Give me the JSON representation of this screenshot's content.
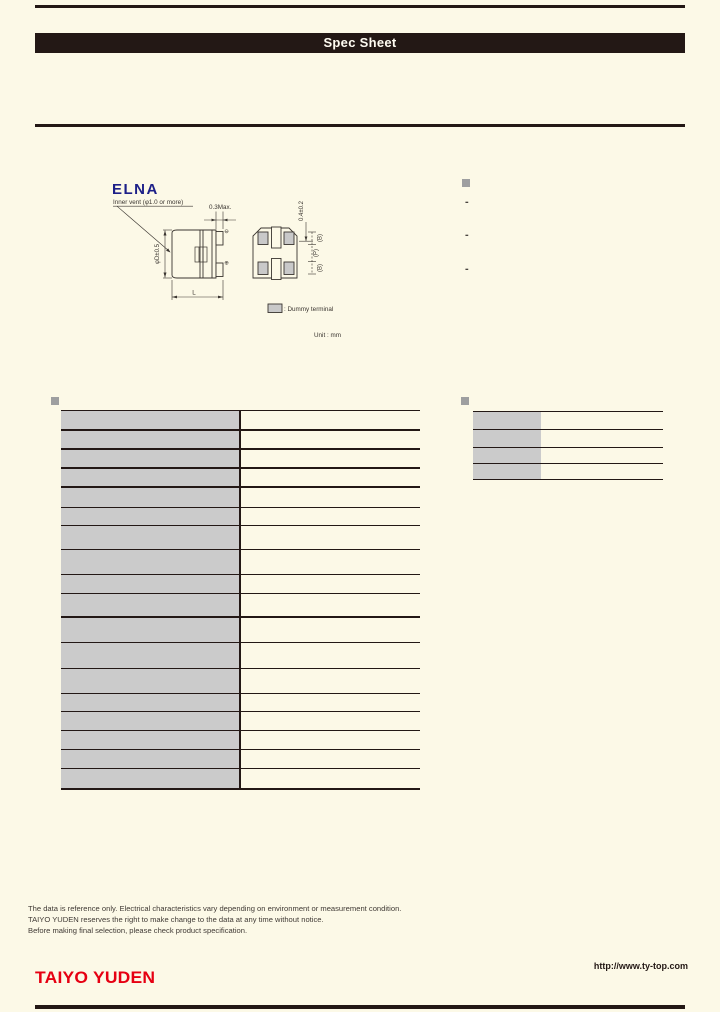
{
  "header": {
    "banner": "Spec Sheet"
  },
  "logos": {
    "elna": "ELNA",
    "taiyo_yuden": "TAIYO YUDEN"
  },
  "colors": {
    "ink": "#231815",
    "paper": "#FCF9E7",
    "table_gray": "#CBCBCB",
    "bullet_gray": "#9E9FA0",
    "elna_blue": "#1D2088",
    "taiyo_red": "#E60012"
  },
  "drawing": {
    "inner_vent_label": "Inner vent (φ1.0 or more)",
    "dim_top": "0.3Max.",
    "dim_diameter": "φD±0.5",
    "dim_length": "L",
    "dim_standoff": "0.4±0.2",
    "dim_b_top": "(B)",
    "dim_pitch": "(P)",
    "dim_b_bottom": "(B)",
    "polarity_top": "⊖",
    "polarity_bottom": "⊕",
    "legend_dummy": ": Dummy terminal",
    "unit": "Unit : mm"
  },
  "features": {
    "bullets": [
      "-",
      "-",
      "-"
    ]
  },
  "spec_table": {
    "rows": [
      {
        "label": "",
        "value": "",
        "h": 20,
        "thick": true
      },
      {
        "label": "",
        "value": "",
        "h": 19,
        "thick": true
      },
      {
        "label": "",
        "value": "",
        "h": 19,
        "thick": true
      },
      {
        "label": "",
        "value": "",
        "h": 19,
        "thick": true
      },
      {
        "label": "",
        "value": "",
        "h": 20,
        "thick": false
      },
      {
        "label": "",
        "value": "",
        "h": 18,
        "thick": false
      },
      {
        "label": "",
        "value": "",
        "h": 24,
        "thick": false
      },
      {
        "label": "",
        "value": "",
        "h": 25,
        "thick": false
      },
      {
        "label": "",
        "value": "",
        "h": 19,
        "thick": false
      },
      {
        "label": "",
        "value": "",
        "h": 24,
        "thick": true
      },
      {
        "label": "",
        "value": "",
        "h": 25,
        "thick": false
      },
      {
        "label": "",
        "value": "",
        "h": 26,
        "thick": false
      },
      {
        "label": "",
        "value": "",
        "h": 25,
        "thick": false
      },
      {
        "label": "",
        "value": "",
        "h": 18,
        "thick": false
      },
      {
        "label": "",
        "value": "",
        "h": 19,
        "thick": false
      },
      {
        "label": "",
        "value": "",
        "h": 19,
        "thick": false
      },
      {
        "label": "",
        "value": "",
        "h": 19,
        "thick": false
      },
      {
        "label": "",
        "value": "",
        "h": 19,
        "thick": false
      }
    ]
  },
  "char_table": {
    "rows": [
      {
        "label": "",
        "value": "",
        "h": 18
      },
      {
        "label": "",
        "value": "",
        "h": 18
      },
      {
        "label": "",
        "value": "",
        "h": 16
      },
      {
        "label": "",
        "value": "",
        "h": 16
      }
    ]
  },
  "footer": {
    "notes": [
      "The data is reference only. Electrical characteristics vary depending on environment or measurement condition.",
      "TAIYO YUDEN reserves the right to make change to the data at any time without notice.",
      "Before making final selection, please check product specification."
    ],
    "url": "http://www.ty-top.com"
  }
}
